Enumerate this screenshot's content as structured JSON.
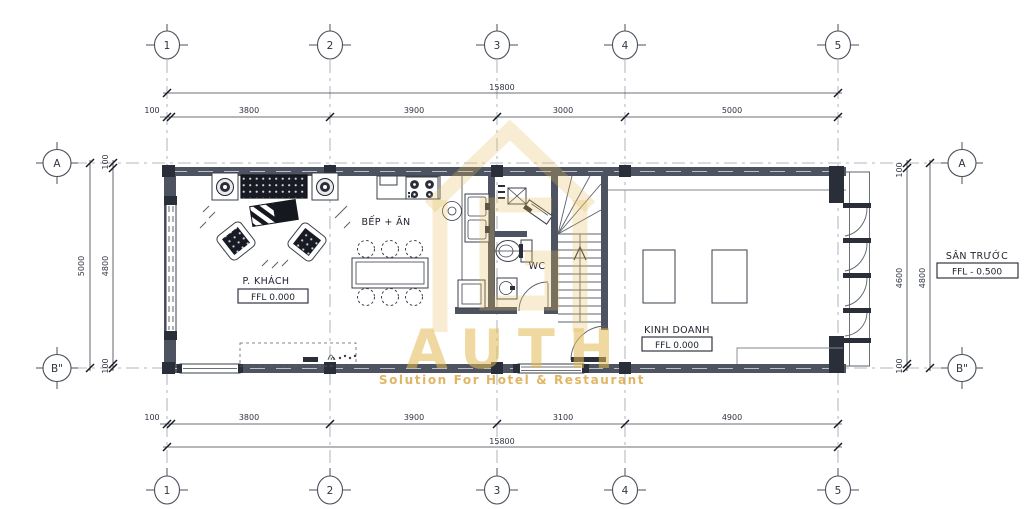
{
  "grid": {
    "columns": [
      "1",
      "2",
      "3",
      "4",
      "5"
    ],
    "rows": [
      "A",
      "B\""
    ]
  },
  "dimensions": {
    "top": {
      "overall": "15800",
      "segments": [
        "100",
        "3800",
        "3900",
        "3000",
        "5000"
      ]
    },
    "bottom": {
      "overall": "15800",
      "segments": [
        "100",
        "3800",
        "3900",
        "3100",
        "4900"
      ]
    },
    "left": {
      "overall": "5000",
      "segments": [
        "100",
        "4800",
        "100"
      ]
    },
    "right": {
      "overall": "4800",
      "segments": [
        "100",
        "4600",
        "100"
      ]
    }
  },
  "rooms": {
    "living": {
      "label": "P. KHÁCH",
      "ffl": "FFL  0.000"
    },
    "kitchen": {
      "label": "BẾP + ĂN"
    },
    "wc": {
      "label": "WC"
    },
    "business": {
      "label": "KINH DOANH",
      "ffl": "FFL  0.000"
    },
    "front_yard": {
      "label": "SÂN TRƯỚC",
      "ffl": "FFL  - 0.500"
    }
  },
  "watermark": {
    "brand": "AUTH",
    "tagline": "Solution For Hotel & Restaurant",
    "color": "#E5C05E"
  },
  "colors": {
    "wall": "#4D5360",
    "column": "#2A2E39",
    "line": "#5B6068",
    "dim_text": "#2F3440",
    "grid_line": "#9AA0AB",
    "watermark_gold": "#E5C05E"
  }
}
